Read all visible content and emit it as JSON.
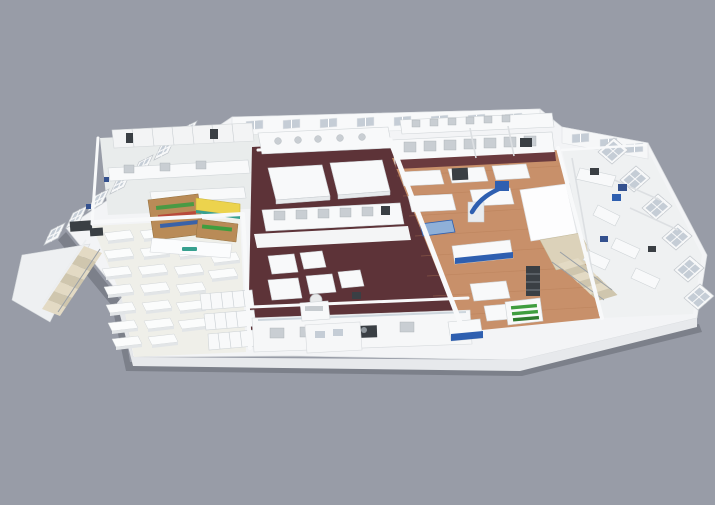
{
  "scene": {
    "kind": "3d-isometric-cutaway-floorplan-render",
    "description": "Isometric 3D cutaway rendering of a single building floor with dining seating, kiosk, dark-floored kitchen blocks, wood-floored production hall, glass partition labs, stair cores and left balcony stairs",
    "background": "#989ca7"
  },
  "palette": {
    "background": "#989ca7",
    "slab_white": "#f3f4f6",
    "slab_face": "#e7e9ec",
    "floor_light": "#efefe9",
    "floor_gray": "#e9ecec",
    "floor_maroon": "#5d3338",
    "maroon_shadow": "#6a3a3e",
    "floor_wood": "#c8906a",
    "glass": "#c5cdd6",
    "awning_yellow": "#ecd34d",
    "kiosk_teal": "#37a08f",
    "kiosk_wood": "#b98b57",
    "produce_green": "#3f9e3f",
    "accent_blue": "#2e5fb0",
    "accent_blue_light": "#8fb0d8",
    "stair_tan": "#dcd2ba",
    "equipment_dark": "#3a3f44",
    "shadow": "rgba(60,64,74,0.30)"
  },
  "zones": [
    {
      "name": "back-wall-windows",
      "note": "row of gray glazed windows along rear wall"
    },
    {
      "name": "prep-kitchen-top-left",
      "floor": "floor_gray"
    },
    {
      "name": "dining-seating-area",
      "floor": "floor_light",
      "tables": "grid of small white tables"
    },
    {
      "name": "service-kiosk",
      "awning": "awning_yellow",
      "shelving": "kiosk_wood",
      "logo": "kiosk_teal"
    },
    {
      "name": "dark-floor-kitchen-block",
      "floor": "floor_maroon"
    },
    {
      "name": "wood-floor-production-hall",
      "floor": "floor_wood",
      "accents": "accent_blue"
    },
    {
      "name": "front-servery-counter"
    },
    {
      "name": "white-utility-core"
    },
    {
      "name": "stair-core-right",
      "steps": "stair_tan"
    },
    {
      "name": "balcony-stairs-left",
      "steps": "stair_tan"
    },
    {
      "name": "glass-partition-labs-right",
      "glazing": "glass"
    },
    {
      "name": "storage-lockers-bottom-left"
    },
    {
      "name": "refrigerated-display-case",
      "contents": "produce_green"
    }
  ]
}
